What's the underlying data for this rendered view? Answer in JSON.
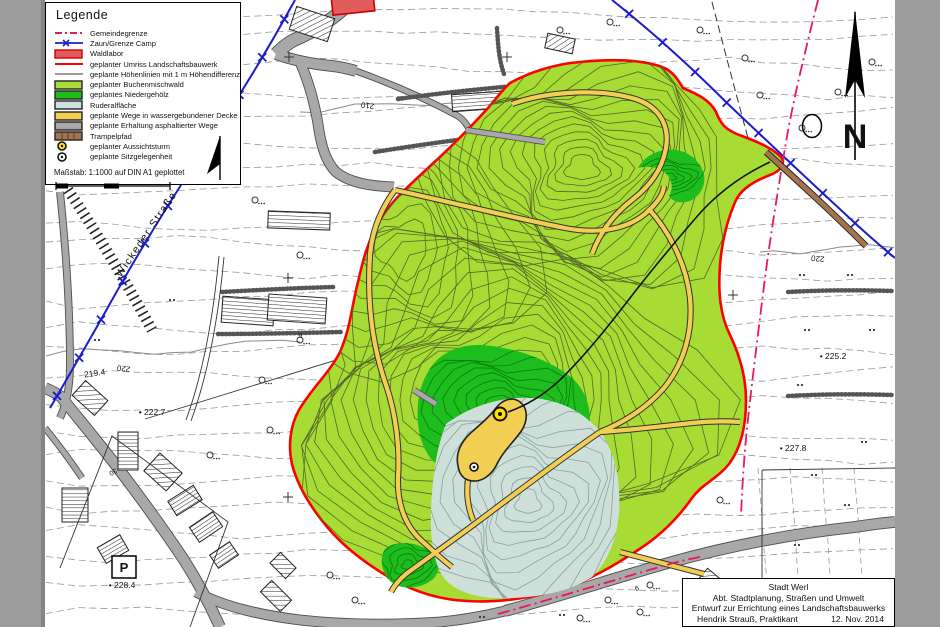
{
  "frame": {
    "side_bar_color": "#9b9b9b"
  },
  "legend": {
    "title": "Legende",
    "items": [
      {
        "symbol": "dashdot-line",
        "color": "#e8185a",
        "label": "Gemeindegrenze"
      },
      {
        "symbol": "x-line",
        "color": "#1c1ccd",
        "label": "Zaun/Grenze Camp"
      },
      {
        "symbol": "rect",
        "color": "#e25c5c",
        "border": "#cc0000",
        "label": "Waldlabor"
      },
      {
        "symbol": "line",
        "color": "#ff0000",
        "label": "geplanter Umriss Landschaftsbauwerk"
      },
      {
        "symbol": "line",
        "color": "#9c9c9c",
        "label": "geplante Höhenlinien mit 1 m Höhendifferenz"
      },
      {
        "symbol": "rect",
        "color": "#aadd37",
        "border": "#222222",
        "label": "geplanter Buchenmischwald"
      },
      {
        "symbol": "rect",
        "color": "#1cbd1c",
        "border": "#222222",
        "label": "geplantes Niedergehölz"
      },
      {
        "symbol": "rect",
        "color": "#cfe0db",
        "border": "#222222",
        "label": "Ruderalfläche"
      },
      {
        "symbol": "rect",
        "color": "#f2ce52",
        "border": "#222222",
        "label": "geplante Wege in wassergebundener Decke"
      },
      {
        "symbol": "rect",
        "color": "#a8a8a8",
        "border": "#222222",
        "label": "geplante Erhaltung asphaltierter Wege"
      },
      {
        "symbol": "rect-hatch",
        "color": "#a5734e",
        "border": "#222222",
        "label": "Trampelpfad"
      },
      {
        "symbol": "circle",
        "color": "#ffe000",
        "label": "geplanter Aussichtsturm"
      },
      {
        "symbol": "circle",
        "color": "#ffffff",
        "label": "geplante Sitzgelegenheit"
      }
    ],
    "scale_text": "Maßstab: 1:1000 auf DIN A1 geplottet"
  },
  "title_block": {
    "line1": "Stadt Werl",
    "line2": "Abt. Stadtplanung, Straßen und Umwelt",
    "line3": "Entwurf zur Errichtung eines Landschaftsbauwerks",
    "line4_left": "Hendrik Strauß, Praktikant",
    "line4_right": "12. Nov. 2014"
  },
  "map": {
    "north_letter": "N",
    "labels": [
      {
        "text": "Wickeder Straße",
        "x": 149,
        "y": 236,
        "rot": -56,
        "size": 10.5,
        "style": "road"
      },
      {
        "text": "210",
        "x": 368,
        "y": 103,
        "rot": 188,
        "size": 8
      },
      {
        "text": "220",
        "x": 124,
        "y": 366,
        "rot": 188,
        "size": 8
      },
      {
        "text": "220",
        "x": 818,
        "y": 256,
        "rot": 185,
        "size": 8
      },
      {
        "text": "219.4",
        "x": 95,
        "y": 376,
        "rot": -8,
        "size": 8.5
      },
      {
        "text": "• 222.7",
        "x": 152,
        "y": 415,
        "rot": 0,
        "size": 8.5
      },
      {
        "text": "• 225.2",
        "x": 833,
        "y": 359,
        "rot": 0,
        "size": 8.5
      },
      {
        "text": "• 227.8",
        "x": 793,
        "y": 451,
        "rot": 0,
        "size": 8.5
      },
      {
        "text": "• 228.4",
        "x": 122,
        "y": 588,
        "rot": 0,
        "size": 8.5
      },
      {
        "text": "P",
        "x": 124,
        "y": 572,
        "rot": 0,
        "size": 13,
        "style": "pbox"
      },
      {
        "text": "6",
        "x": 300,
        "y": 333,
        "rot": 170,
        "size": 7
      },
      {
        "text": "9",
        "x": 636,
        "y": 586,
        "rot": 160,
        "size": 7
      },
      {
        "text": "30",
        "x": 112,
        "y": 470,
        "rot": 150,
        "size": 7
      }
    ]
  },
  "colors": {
    "buchenmischwald": "#a6dc33",
    "niedergehoelz": "#1cbd1c",
    "ruderalflaeche": "#cfe0db",
    "wege": "#f2ce52",
    "asphalt": "#a8a8a8",
    "trampelpfad": "#a5734e",
    "umriss": "#ff0000",
    "gemeindegrenze": "#e8185a",
    "zaun": "#1c1ccd",
    "hoehenlinien": "#999999",
    "waldlabor": "#e25c5c"
  }
}
